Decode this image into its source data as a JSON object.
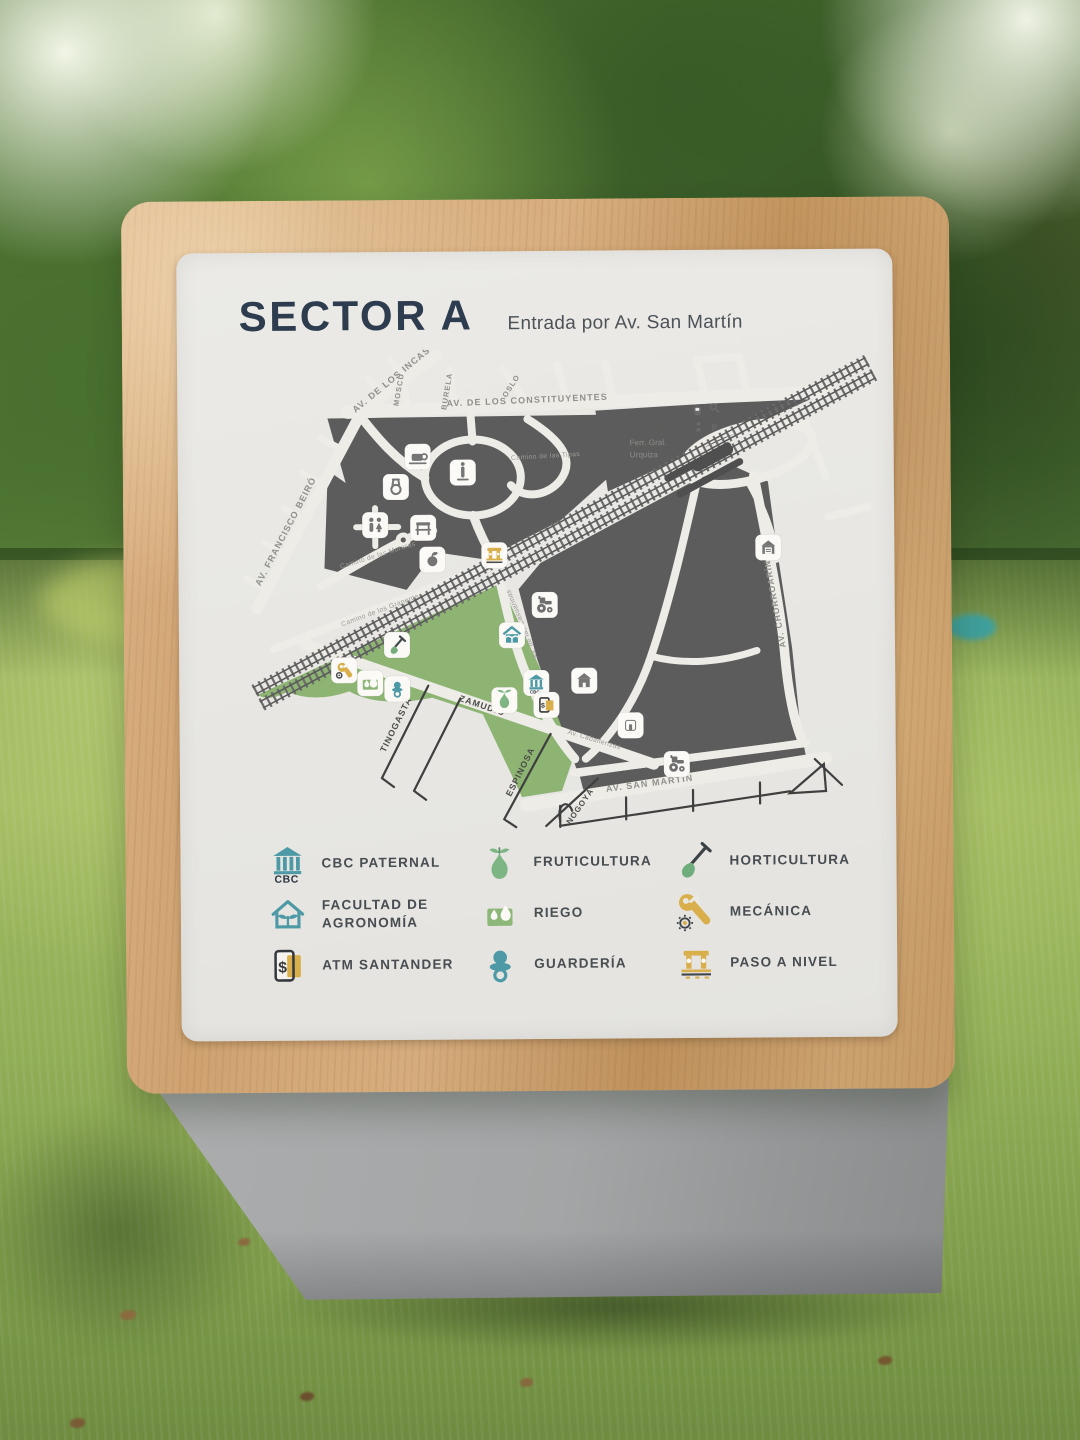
{
  "sign": {
    "title": "SECTOR A",
    "subtitle": "Entrada por Av. San Martín"
  },
  "map": {
    "station": {
      "name_line1": "ESTACIÓN",
      "name_line2": "ARATA",
      "operator_line1": "Ferr. Gral.",
      "operator_line2": "Urquiza"
    },
    "streets": {
      "constituyentes": "AV. DE LOS CONSTITUYENTES",
      "incas": "AV. DE LOS INCAS",
      "beiro": "AV. FRANCISCO BEIRÓ",
      "chorroarin": "AV. CHORROARÍN",
      "san_martin": "AV. SAN MARTÍN",
      "moscu": "MOSCÚ",
      "burela": "BURELA",
      "oslo": "OSLO",
      "tinogasta": "TINOGASTA",
      "zamudio": "ZAMUDIO",
      "espinosa": "ESPINOSA",
      "nogoya": "NOGOYÁ",
      "casuarinas": "Av. de las Casuarinas",
      "caballerizas": "Av. Caballerizas",
      "tipas": "Camino de las Tipas",
      "graneros": "Camino de los Graneros",
      "moreras": "Camino de las Moreras"
    },
    "icon_names": [
      "cafe-icon",
      "monument-icon",
      "medal-icon",
      "restrooms-icon",
      "kiosk-icon",
      "fruit-icon",
      "level-crossing-icon",
      "tractor-icon",
      "agronomy-faculty-icon",
      "shovel-icon",
      "wrench-gear-icon",
      "irrigation-icon",
      "pacifier-icon",
      "cbc-building-icon",
      "building-icon",
      "pear-icon",
      "atm-icon",
      "small-building-icon",
      "garage-icon",
      "train-icon",
      "magnifier-icon",
      "person-icon",
      "parking-icon"
    ],
    "cbc_text": "CBC"
  },
  "legend": {
    "items": [
      {
        "label": "CBC PATERNAL",
        "icon": "cbc-building-icon"
      },
      {
        "label": "FACULTAD DE AGRONOMÍA",
        "icon": "agronomy-faculty-icon"
      },
      {
        "label": "ATM SANTANDER",
        "icon": "atm-card-icon"
      },
      {
        "label": "FRUTICULTURA",
        "icon": "pear-icon"
      },
      {
        "label": "RIEGO",
        "icon": "irrigation-drops-icon"
      },
      {
        "label": "GUARDERÍA",
        "icon": "pacifier-icon"
      },
      {
        "label": "HORTICULTURA",
        "icon": "shovel-icon"
      },
      {
        "label": "MECÁNICA",
        "icon": "wrench-gear-icon"
      },
      {
        "label": "PASO A NIVEL",
        "icon": "level-crossing-icon"
      }
    ],
    "cbc_text": "CBC"
  },
  "colors": {
    "teal": "#4d9aa6",
    "leaf_green": "#7db584",
    "park_green": "#8eb473",
    "gold": "#d9af4c",
    "map_block_gray": "#5c5c5c",
    "title_navy": "#2d3c4e",
    "panel_bg": "#e9e8e4",
    "wood_tan": "#cfa270",
    "pedestal_gray": "#a0a2a3"
  }
}
